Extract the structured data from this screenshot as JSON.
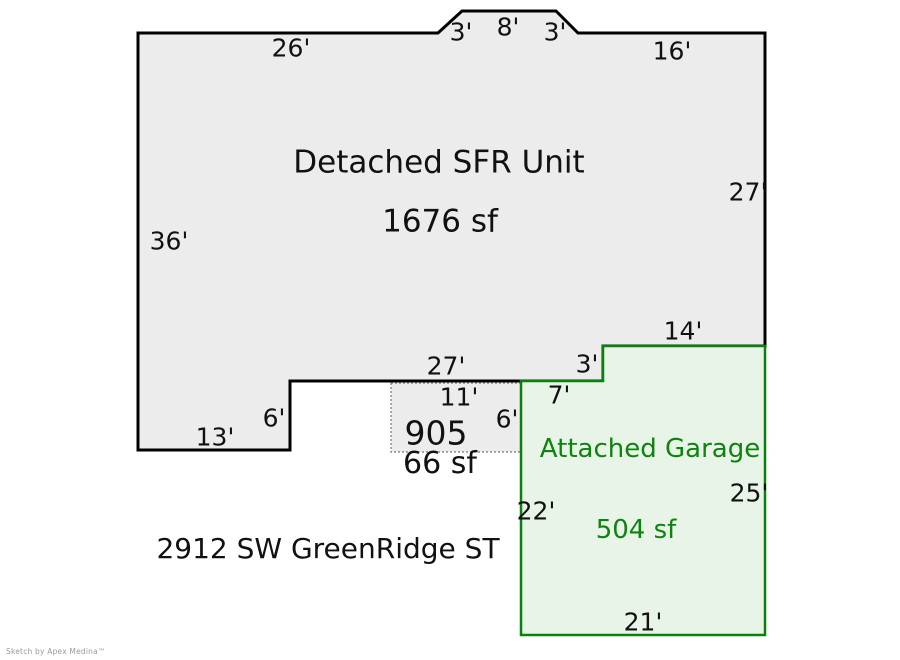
{
  "colors": {
    "building-fill": "#ececec",
    "building-stroke": "#000000",
    "porch-fill": "#ececec",
    "porch-stroke": "#777777",
    "garage-fill": "#e9f4e9",
    "garage-stroke": "#0a810a",
    "garage-text": "#0e830e",
    "watermark-color": "#9a9a9a"
  },
  "building": {
    "name": "Detached SFR Unit",
    "area": "1676 sf"
  },
  "garage": {
    "name": "Attached Garage",
    "area": "504 sf"
  },
  "porch": {
    "name": "905",
    "area": "66 sf"
  },
  "address": "2912 SW GreenRidge ST",
  "watermark": "Sketch by Apex Medina™",
  "dims": {
    "top_26": "26'",
    "top_3a": "3'",
    "top_8": "8'",
    "top_3b": "3'",
    "top_16": "16'",
    "right_27": "27'",
    "left_36": "36'",
    "garage_top_14": "14'",
    "bottom_27": "27'",
    "step_3": "3'",
    "step_7": "7'",
    "porch_11": "11'",
    "porch_6": "6'",
    "left_step_6": "6'",
    "bottom_13": "13'",
    "garage_left_22": "22'",
    "garage_right_25": "25'",
    "garage_bottom_21": "21'"
  }
}
